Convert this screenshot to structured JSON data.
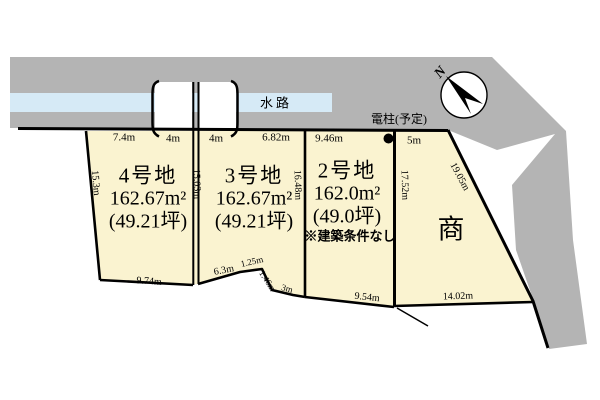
{
  "diagram_type": "land-plot-layout",
  "colors": {
    "road_gray": "#b4b4b4",
    "waterway_blue": "#d6eaf6",
    "plot_cream": "#faf3d0",
    "outline_black": "#000000"
  },
  "compass": {
    "label": "N"
  },
  "waterway": {
    "label": "水路"
  },
  "utility_pole": {
    "label": "電柱(予定)"
  },
  "dims": {
    "top_74": "7.4m",
    "top_4a": "4m",
    "top_4b": "4m",
    "top_682": "6.82m",
    "top_946": "9.46m",
    "top_5": "5m",
    "left_153": "15.3m",
    "mid_1503": "15.03m",
    "mid_1648": "16.48m",
    "mid_1752": "17.52m",
    "diag_1905": "19.05m",
    "bot_974": "9.74m",
    "bot_63": "6.3m",
    "bot_125": "1.25m",
    "bot_146": "1.46m",
    "bot_3": "3m",
    "bot_954": "9.54m",
    "bot_1402": "14.02m"
  },
  "plots": [
    {
      "name": "4号地",
      "area": "162.67m²",
      "tsubo": "(49.21坪)"
    },
    {
      "name": "3号地",
      "area": "162.67m²",
      "tsubo": "(49.21坪)"
    },
    {
      "name": "2号地",
      "area": "162.0m²",
      "tsubo": "(49.0坪)",
      "note": "※建築条件なし"
    },
    {
      "name": "商"
    }
  ]
}
